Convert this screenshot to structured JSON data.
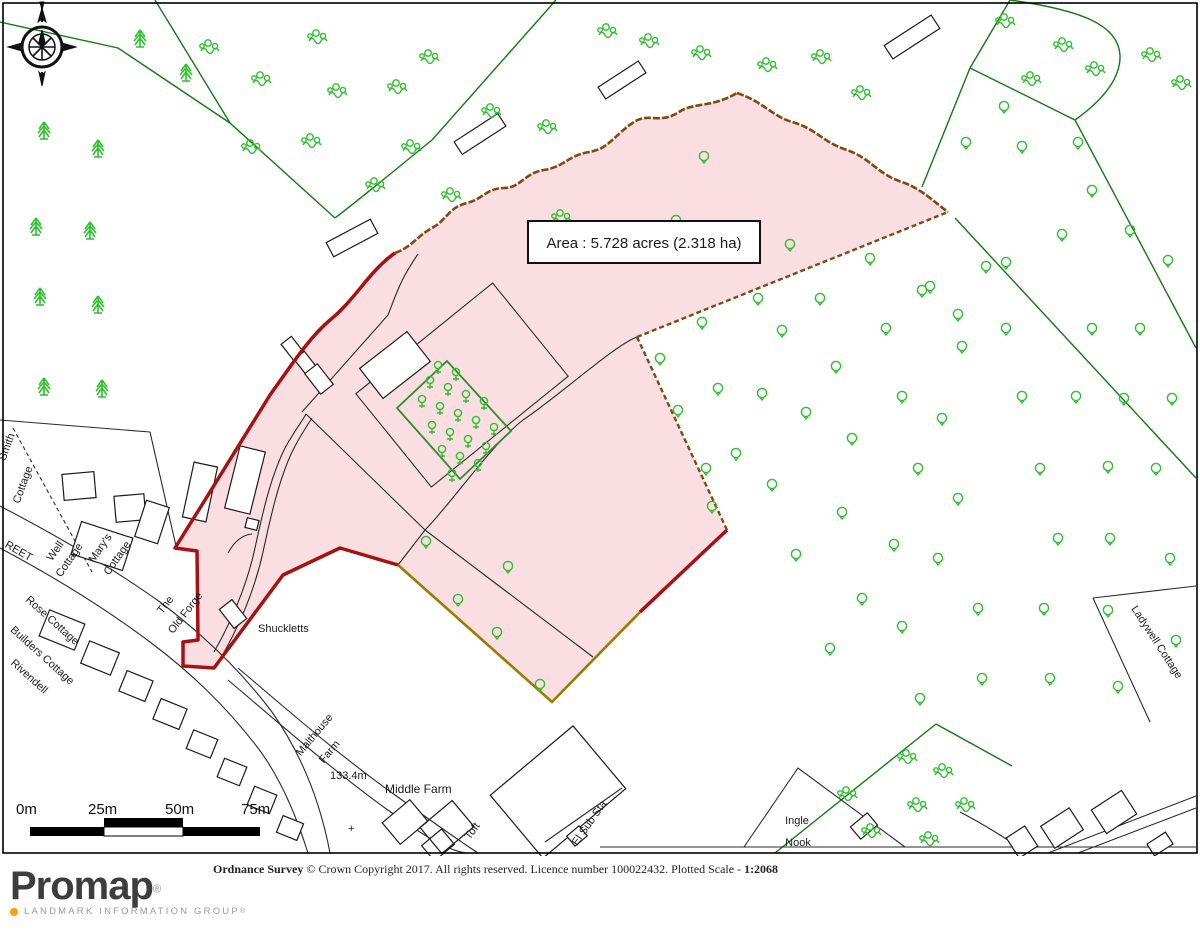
{
  "map": {
    "area_label": "Area : 5.728 acres (2.318 ha)",
    "labels": {
      "smith1": "Smith",
      "smith2": "Cottage",
      "well1": "Well",
      "well2": "Cottage",
      "marys1": "Mary's",
      "marys2": "Cottage",
      "forge1": "The",
      "forge2": "Old Forge",
      "rose": "Rose Cottage",
      "builders": "Builders Cottage",
      "rivendell": "Rivendell",
      "street": "REET",
      "shuckletts": "Shuckletts",
      "malthouse1": "Malthouse",
      "malthouse2": "Farm",
      "spot_height": "133.4m",
      "benchmark": "+",
      "middle_farm": "Middle Farm",
      "toft": "Toft",
      "sub_sta": "El Sub Sta",
      "ingle1": "Ingle",
      "ingle2": "Nook",
      "ladywell": "Ladywell Cottage"
    },
    "colors": {
      "parcel_fill": "#fadee1",
      "parcel_border_red": "#a61111",
      "parcel_border_olive": "#9a7b00",
      "parcel_border_brown": "#7d4a10",
      "vegetation_green": "#2ebf2e",
      "boundary_green": "#137813"
    }
  },
  "scalebar": {
    "t0": "0m",
    "t25": "25m",
    "t50": "50m",
    "t75": "75m"
  },
  "footer": {
    "attribution_bold": "Ordnance Survey",
    "attribution_mid": "  © Crown Copyright 2017. All rights reserved. Licence number 100022432. Plotted Scale -  ",
    "attribution_scale": "1:2068",
    "brand": "Promap",
    "brand_mark": "®",
    "tagline": "LANDMARK INFORMATION GROUP",
    "tagline_mark": "®"
  }
}
